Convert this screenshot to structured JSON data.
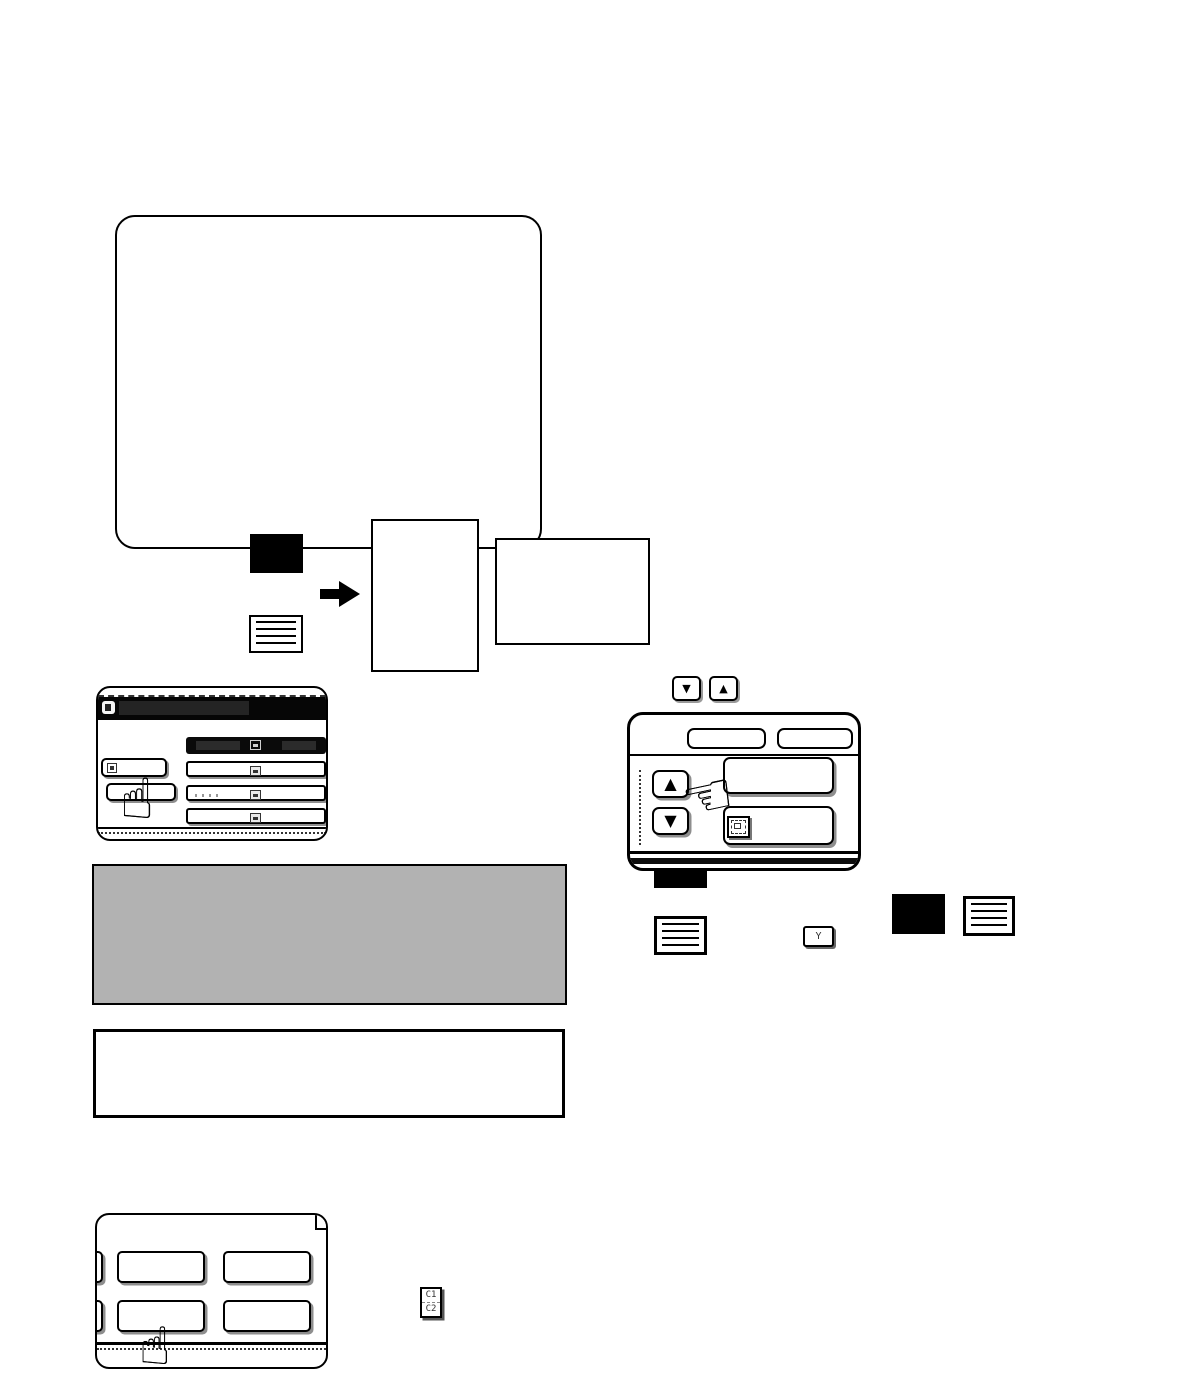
{
  "colors": {
    "page_bg": "#ffffff",
    "ink": "#000000",
    "note_fill": "#b2b2b2",
    "titlebar_black": "#060606"
  },
  "glyphs": {
    "hand_point_up": "☝",
    "hand_point_left": "☜",
    "triangle_up": "▲",
    "triangle_down": "▼"
  },
  "figure_dual_page_copy": {
    "parts": [
      "original-image-block",
      "original-text-block",
      "right-arrow",
      "portrait-copy-page",
      "landscape-copy-sheet"
    ]
  },
  "scroll_keys": {
    "down": "▼",
    "up": "▲"
  },
  "panels": {
    "left_touch_panel": {
      "right_rows": 4,
      "left_buttons": 2
    },
    "right_touch_panel": {
      "top_buttons": 2,
      "scroll_up": "▲",
      "scroll_down": "▼"
    },
    "bottom_touch_panel": {
      "buttons": 4
    }
  },
  "inline_keys": {
    "y_key": "Y",
    "tray_key_line1": "C1",
    "tray_key_line2": "C2"
  }
}
